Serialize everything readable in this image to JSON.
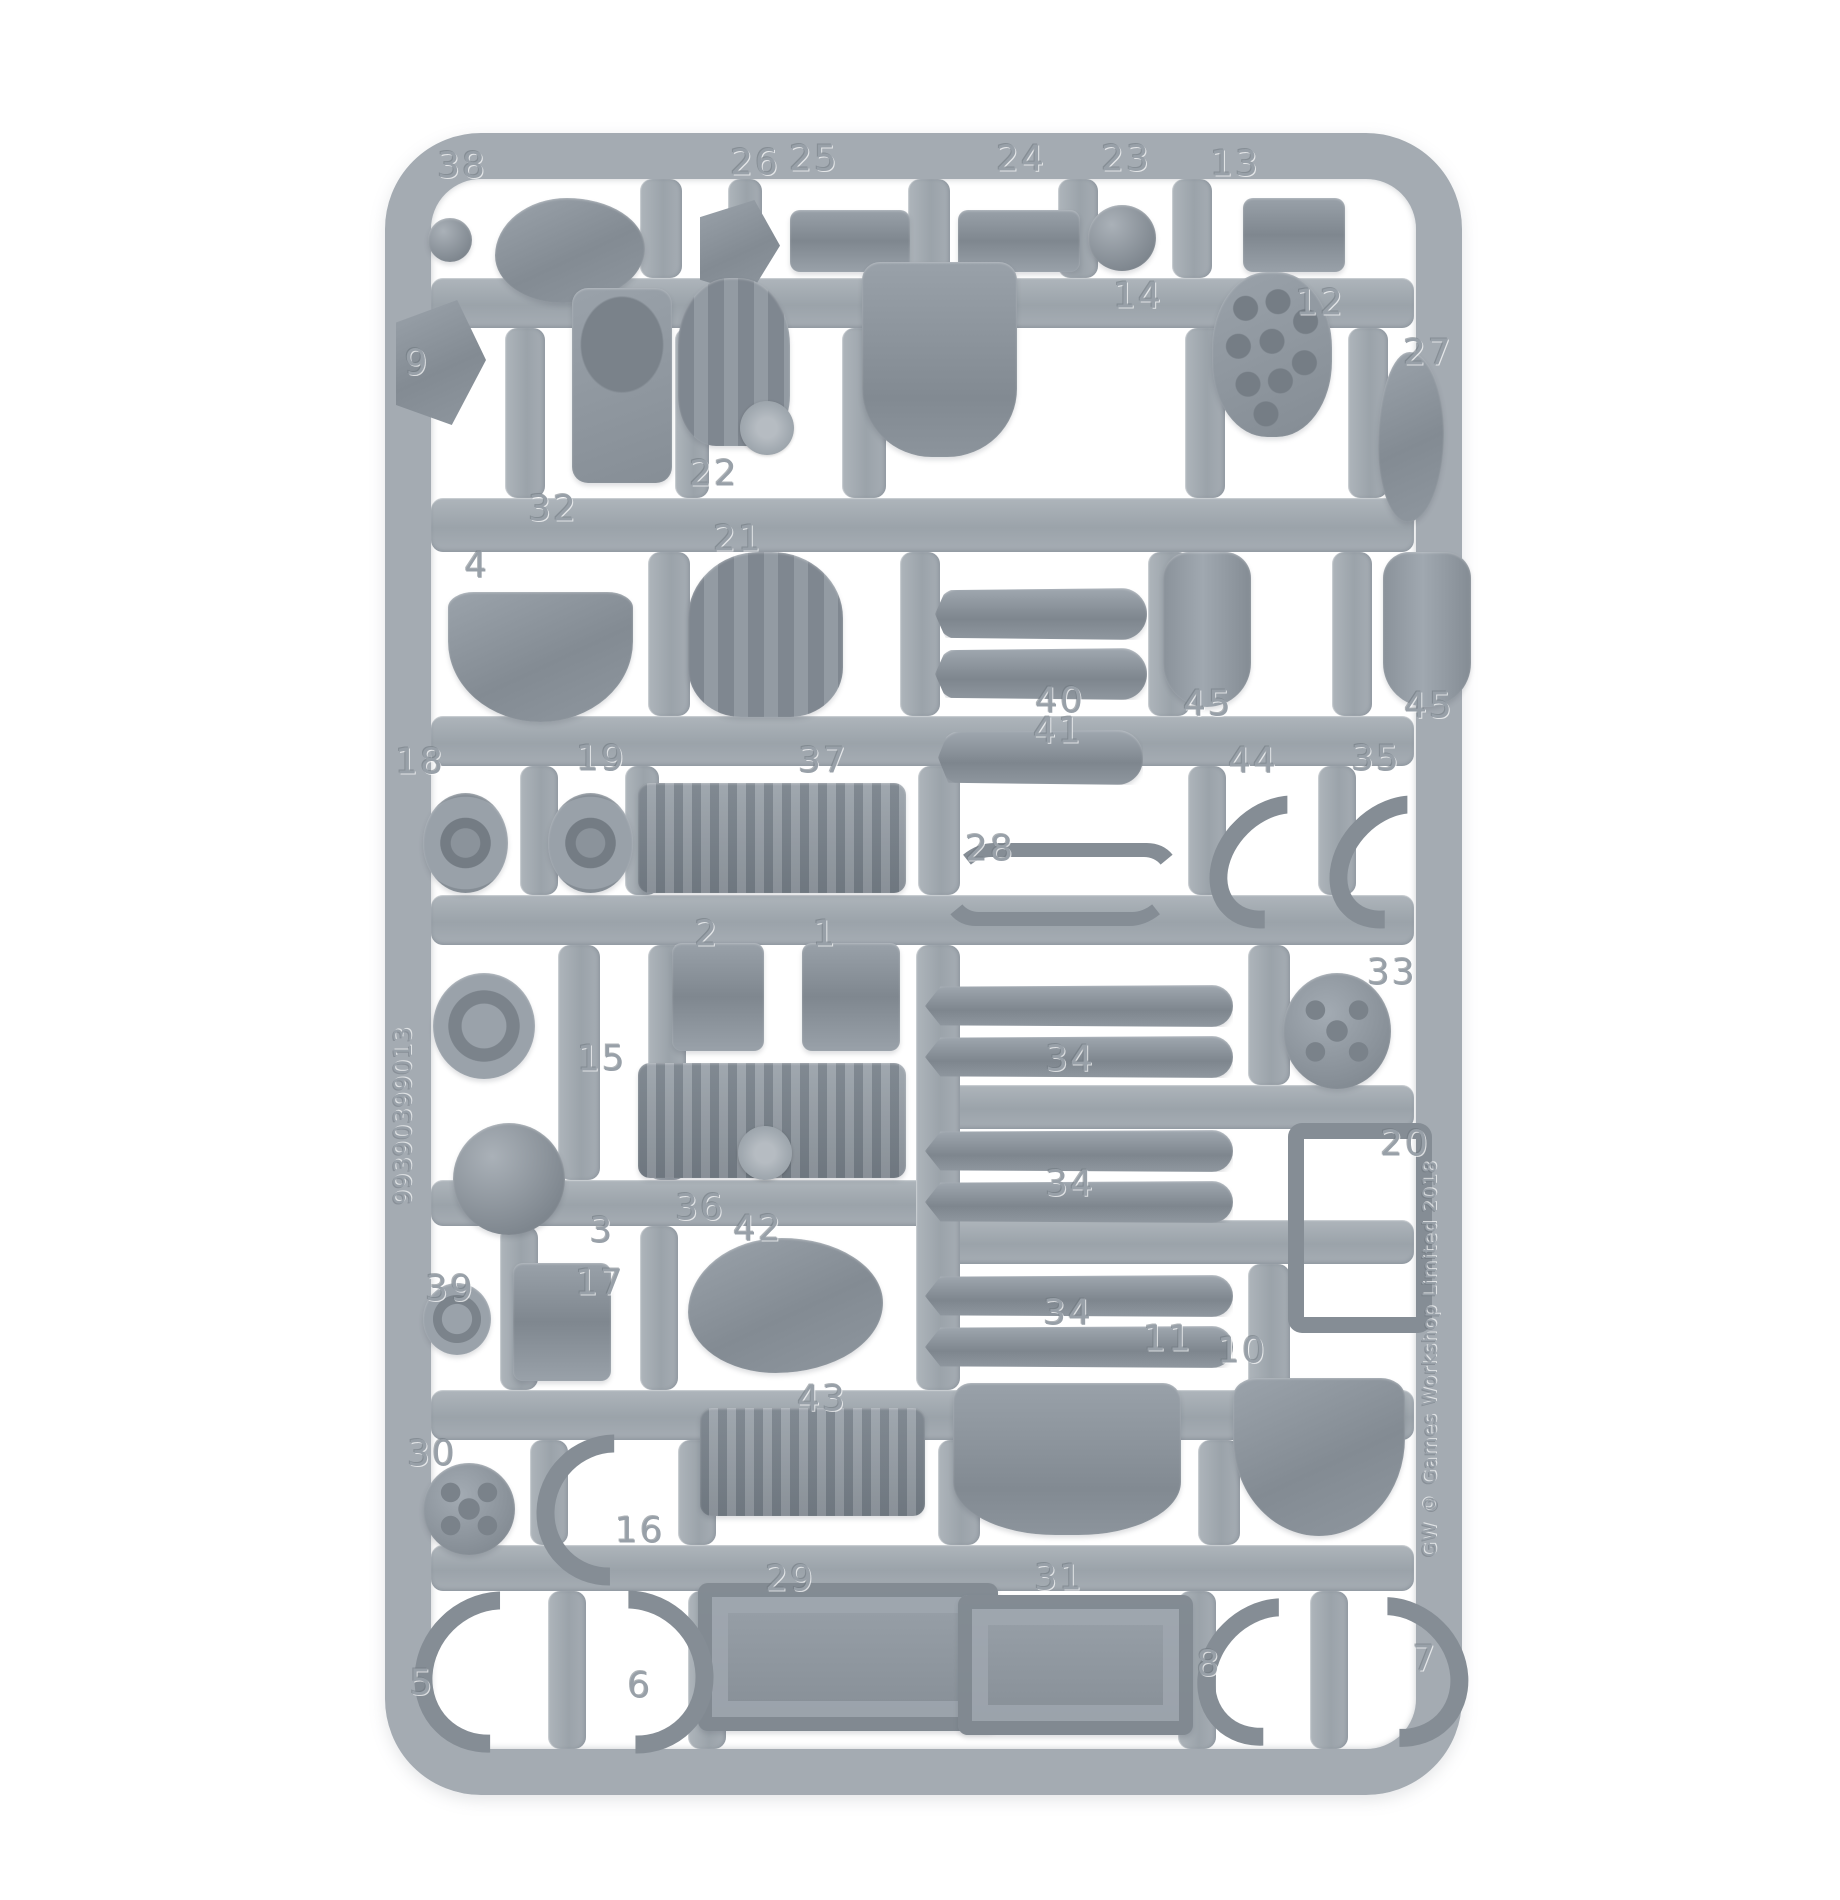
{
  "image": {
    "type": "product-photo",
    "subject": "gray plastic model kit sprue (miniature parts frame) on white background",
    "background_color": "#ffffff"
  },
  "sprue": {
    "plastic_color": "#a4abb2",
    "part_shade_color": "#868e96",
    "left_rail_code": "99390399013",
    "right_rail_code": "GW © Games Workshop Limited 2018",
    "part_labels": [
      {
        "n": "38",
        "x": 462,
        "y": 166
      },
      {
        "n": "26",
        "x": 755,
        "y": 163
      },
      {
        "n": "25",
        "x": 814,
        "y": 159
      },
      {
        "n": "24",
        "x": 1021,
        "y": 159
      },
      {
        "n": "23",
        "x": 1126,
        "y": 159
      },
      {
        "n": "13",
        "x": 1235,
        "y": 164
      },
      {
        "n": "14",
        "x": 1138,
        "y": 296
      },
      {
        "n": "12",
        "x": 1320,
        "y": 303
      },
      {
        "n": "27",
        "x": 1428,
        "y": 353
      },
      {
        "n": "9",
        "x": 417,
        "y": 363
      },
      {
        "n": "32",
        "x": 553,
        "y": 509
      },
      {
        "n": "22",
        "x": 714,
        "y": 474
      },
      {
        "n": "21",
        "x": 738,
        "y": 539
      },
      {
        "n": "4",
        "x": 477,
        "y": 566
      },
      {
        "n": "40",
        "x": 1060,
        "y": 701
      },
      {
        "n": "41",
        "x": 1058,
        "y": 731
      },
      {
        "n": "45",
        "x": 1208,
        "y": 704
      },
      {
        "n": "45",
        "x": 1429,
        "y": 706
      },
      {
        "n": "44",
        "x": 1253,
        "y": 761
      },
      {
        "n": "35",
        "x": 1376,
        "y": 759
      },
      {
        "n": "18",
        "x": 420,
        "y": 762
      },
      {
        "n": "19",
        "x": 601,
        "y": 759
      },
      {
        "n": "37",
        "x": 823,
        "y": 761
      },
      {
        "n": "28",
        "x": 990,
        "y": 849
      },
      {
        "n": "2",
        "x": 707,
        "y": 934
      },
      {
        "n": "1",
        "x": 825,
        "y": 934
      },
      {
        "n": "33",
        "x": 1392,
        "y": 973
      },
      {
        "n": "15",
        "x": 602,
        "y": 1059
      },
      {
        "n": "34",
        "x": 1070,
        "y": 1059
      },
      {
        "n": "34",
        "x": 1070,
        "y": 1184
      },
      {
        "n": "34",
        "x": 1068,
        "y": 1313
      },
      {
        "n": "3",
        "x": 602,
        "y": 1231
      },
      {
        "n": "36",
        "x": 700,
        "y": 1208
      },
      {
        "n": "42",
        "x": 758,
        "y": 1229
      },
      {
        "n": "20",
        "x": 1405,
        "y": 1144
      },
      {
        "n": "39",
        "x": 450,
        "y": 1289
      },
      {
        "n": "17",
        "x": 600,
        "y": 1283
      },
      {
        "n": "43",
        "x": 822,
        "y": 1399
      },
      {
        "n": "11",
        "x": 1168,
        "y": 1339
      },
      {
        "n": "10",
        "x": 1242,
        "y": 1351
      },
      {
        "n": "30",
        "x": 432,
        "y": 1454
      },
      {
        "n": "16",
        "x": 640,
        "y": 1531
      },
      {
        "n": "29",
        "x": 790,
        "y": 1579
      },
      {
        "n": "31",
        "x": 1059,
        "y": 1578
      },
      {
        "n": "5",
        "x": 422,
        "y": 1683
      },
      {
        "n": "6",
        "x": 640,
        "y": 1686
      },
      {
        "n": "8",
        "x": 1209,
        "y": 1664
      },
      {
        "n": "7",
        "x": 1425,
        "y": 1659
      }
    ],
    "rails": {
      "horizontal": [
        {
          "x": 431,
          "y": 278,
          "w": 983,
          "h": 50
        },
        {
          "x": 431,
          "y": 498,
          "w": 983,
          "h": 54
        },
        {
          "x": 431,
          "y": 716,
          "w": 983,
          "h": 50
        },
        {
          "x": 431,
          "y": 895,
          "w": 983,
          "h": 50
        },
        {
          "x": 925,
          "y": 1085,
          "w": 489,
          "h": 44
        },
        {
          "x": 431,
          "y": 1180,
          "w": 500,
          "h": 46
        },
        {
          "x": 925,
          "y": 1220,
          "w": 489,
          "h": 44
        },
        {
          "x": 431,
          "y": 1390,
          "w": 983,
          "h": 50
        },
        {
          "x": 431,
          "y": 1545,
          "w": 983,
          "h": 46
        }
      ],
      "vertical": [
        {
          "x": 640,
          "y": 179,
          "w": 42,
          "h": 99
        },
        {
          "x": 728,
          "y": 179,
          "w": 34,
          "h": 99
        },
        {
          "x": 908,
          "y": 179,
          "w": 42,
          "h": 99
        },
        {
          "x": 1058,
          "y": 179,
          "w": 40,
          "h": 99
        },
        {
          "x": 1172,
          "y": 179,
          "w": 40,
          "h": 99
        },
        {
          "x": 505,
          "y": 328,
          "w": 40,
          "h": 170
        },
        {
          "x": 675,
          "y": 328,
          "w": 34,
          "h": 170
        },
        {
          "x": 842,
          "y": 328,
          "w": 44,
          "h": 170
        },
        {
          "x": 1185,
          "y": 328,
          "w": 40,
          "h": 170
        },
        {
          "x": 1348,
          "y": 328,
          "w": 40,
          "h": 170
        },
        {
          "x": 648,
          "y": 552,
          "w": 42,
          "h": 164
        },
        {
          "x": 900,
          "y": 552,
          "w": 40,
          "h": 164
        },
        {
          "x": 1148,
          "y": 552,
          "w": 42,
          "h": 164
        },
        {
          "x": 1332,
          "y": 552,
          "w": 40,
          "h": 164
        },
        {
          "x": 520,
          "y": 766,
          "w": 38,
          "h": 129
        },
        {
          "x": 625,
          "y": 766,
          "w": 34,
          "h": 129
        },
        {
          "x": 918,
          "y": 766,
          "w": 42,
          "h": 129
        },
        {
          "x": 1188,
          "y": 766,
          "w": 38,
          "h": 129
        },
        {
          "x": 1318,
          "y": 766,
          "w": 38,
          "h": 129
        },
        {
          "x": 558,
          "y": 945,
          "w": 42,
          "h": 235
        },
        {
          "x": 648,
          "y": 945,
          "w": 38,
          "h": 235
        },
        {
          "x": 916,
          "y": 945,
          "w": 44,
          "h": 445
        },
        {
          "x": 1248,
          "y": 945,
          "w": 42,
          "h": 140
        },
        {
          "x": 500,
          "y": 1226,
          "w": 38,
          "h": 164
        },
        {
          "x": 640,
          "y": 1226,
          "w": 38,
          "h": 164
        },
        {
          "x": 1248,
          "y": 1264,
          "w": 42,
          "h": 126
        },
        {
          "x": 530,
          "y": 1440,
          "w": 38,
          "h": 105
        },
        {
          "x": 678,
          "y": 1440,
          "w": 38,
          "h": 105
        },
        {
          "x": 938,
          "y": 1440,
          "w": 42,
          "h": 105
        },
        {
          "x": 1198,
          "y": 1440,
          "w": 42,
          "h": 105
        },
        {
          "x": 548,
          "y": 1591,
          "w": 38,
          "h": 158
        },
        {
          "x": 688,
          "y": 1591,
          "w": 38,
          "h": 158
        },
        {
          "x": 1178,
          "y": 1591,
          "w": 38,
          "h": 158
        },
        {
          "x": 1310,
          "y": 1591,
          "w": 38,
          "h": 158
        }
      ]
    },
    "parts": [
      {
        "name": "ball-joint-pin",
        "shape": "ball",
        "x": 428,
        "y": 218,
        "w": 44,
        "h": 44
      },
      {
        "name": "sensor-head",
        "shape": "blob",
        "x": 495,
        "y": 198,
        "w": 150,
        "h": 105
      },
      {
        "name": "small-bracket",
        "shape": "wedge",
        "x": 700,
        "y": 200,
        "w": 80,
        "h": 95
      },
      {
        "name": "bolter-body-a",
        "shape": "gadget",
        "x": 790,
        "y": 210,
        "w": 120,
        "h": 62
      },
      {
        "name": "bolter-body-b",
        "shape": "gadget",
        "x": 958,
        "y": 210,
        "w": 122,
        "h": 62
      },
      {
        "name": "orb-joint",
        "shape": "ball",
        "x": 1088,
        "y": 205,
        "w": 68,
        "h": 66
      },
      {
        "name": "twin-drum",
        "shape": "gadget",
        "x": 1243,
        "y": 198,
        "w": 102,
        "h": 74
      },
      {
        "name": "angled-vane",
        "shape": "wedge",
        "x": 396,
        "y": 300,
        "w": 90,
        "h": 125
      },
      {
        "name": "hatch-plate",
        "shape": "hatch",
        "x": 572,
        "y": 288,
        "w": 100,
        "h": 195
      },
      {
        "name": "claw-gauntlet-a",
        "shape": "claw",
        "x": 678,
        "y": 278,
        "w": 112,
        "h": 168
      },
      {
        "name": "torso-panel",
        "shape": "panel",
        "x": 862,
        "y": 262,
        "w": 155,
        "h": 195
      },
      {
        "name": "missile-plate",
        "shape": "bumps",
        "x": 1212,
        "y": 272,
        "w": 120,
        "h": 165
      },
      {
        "name": "small-arm",
        "shape": "blob",
        "x": 1378,
        "y": 352,
        "w": 66,
        "h": 170
      },
      {
        "name": "backpack-shield",
        "shape": "shield",
        "x": 448,
        "y": 592,
        "w": 185,
        "h": 130
      },
      {
        "name": "claw-gauntlet-b",
        "shape": "claw",
        "x": 688,
        "y": 552,
        "w": 155,
        "h": 165
      },
      {
        "name": "twin-cylinder-top",
        "shape": "rod",
        "x": 935,
        "y": 588,
        "w": 212,
        "h": 52
      },
      {
        "name": "twin-cylinder-bottom",
        "shape": "rod",
        "x": 935,
        "y": 648,
        "w": 212,
        "h": 52
      },
      {
        "name": "single-cylinder",
        "shape": "rod",
        "x": 938,
        "y": 730,
        "w": 205,
        "h": 55
      },
      {
        "name": "fuel-tank-a",
        "shape": "tank",
        "x": 1163,
        "y": 552,
        "w": 88,
        "h": 155
      },
      {
        "name": "fuel-tank-b",
        "shape": "tank",
        "x": 1383,
        "y": 552,
        "w": 88,
        "h": 155
      },
      {
        "name": "pulley-wheel-a",
        "shape": "wheel",
        "x": 423,
        "y": 793,
        "w": 85,
        "h": 100
      },
      {
        "name": "pulley-wheel-b",
        "shape": "wheel",
        "x": 548,
        "y": 793,
        "w": 85,
        "h": 100
      },
      {
        "name": "engine-block-a",
        "shape": "engine",
        "x": 638,
        "y": 783,
        "w": 268,
        "h": 110
      },
      {
        "name": "hose-pair",
        "shape": "hose-s",
        "x": 945,
        "y": 843,
        "w": 205,
        "h": 55
      },
      {
        "name": "elbow-hose-a",
        "shape": "hose-l",
        "x": 1218,
        "y": 788,
        "w": 80,
        "h": 112
      },
      {
        "name": "elbow-hose-b",
        "shape": "hose-l",
        "x": 1338,
        "y": 788,
        "w": 80,
        "h": 112
      },
      {
        "name": "porthole",
        "shape": "ring",
        "x": 433,
        "y": 973,
        "w": 102,
        "h": 106
      },
      {
        "name": "clamp-a",
        "shape": "gadget",
        "x": 672,
        "y": 943,
        "w": 92,
        "h": 108
      },
      {
        "name": "clamp-b",
        "shape": "gadget",
        "x": 802,
        "y": 943,
        "w": 98,
        "h": 108
      },
      {
        "name": "piston-rod-a1",
        "shape": "rod",
        "x": 925,
        "y": 985,
        "w": 308,
        "h": 42
      },
      {
        "name": "piston-rod-a2",
        "shape": "rod",
        "x": 925,
        "y": 1036,
        "w": 308,
        "h": 42
      },
      {
        "name": "rivet-drum",
        "shape": "drum",
        "x": 1283,
        "y": 973,
        "w": 108,
        "h": 116
      },
      {
        "name": "engine-block-b",
        "shape": "engine",
        "x": 638,
        "y": 1063,
        "w": 268,
        "h": 115
      },
      {
        "name": "orb-sphere",
        "shape": "ball",
        "x": 453,
        "y": 1123,
        "w": 112,
        "h": 112
      },
      {
        "name": "piston-rod-b1",
        "shape": "rod",
        "x": 925,
        "y": 1130,
        "w": 308,
        "h": 42
      },
      {
        "name": "piston-rod-b2",
        "shape": "rod",
        "x": 925,
        "y": 1181,
        "w": 308,
        "h": 42
      },
      {
        "name": "frame-bracket",
        "shape": "frame",
        "x": 1288,
        "y": 1123,
        "w": 112,
        "h": 178
      },
      {
        "name": "small-rosette",
        "shape": "ring",
        "x": 423,
        "y": 1283,
        "w": 68,
        "h": 72
      },
      {
        "name": "cylinder-stack",
        "shape": "gadget",
        "x": 513,
        "y": 1263,
        "w": 98,
        "h": 118
      },
      {
        "name": "curved-cowling",
        "shape": "blob",
        "x": 688,
        "y": 1238,
        "w": 195,
        "h": 135
      },
      {
        "name": "piston-rod-c1",
        "shape": "rod",
        "x": 925,
        "y": 1275,
        "w": 308,
        "h": 42
      },
      {
        "name": "piston-rod-c2",
        "shape": "rod",
        "x": 925,
        "y": 1326,
        "w": 308,
        "h": 42
      },
      {
        "name": "rail-gun-body",
        "shape": "engine",
        "x": 700,
        "y": 1408,
        "w": 225,
        "h": 108
      },
      {
        "name": "hex-housing",
        "shape": "panel",
        "x": 953,
        "y": 1383,
        "w": 228,
        "h": 152
      },
      {
        "name": "crested-shield",
        "shape": "shield",
        "x": 1233,
        "y": 1378,
        "w": 172,
        "h": 158
      },
      {
        "name": "round-rosette",
        "shape": "drum",
        "x": 423,
        "y": 1463,
        "w": 92,
        "h": 92
      },
      {
        "name": "curved-horn",
        "shape": "hose-l",
        "x": 538,
        "y": 1433,
        "w": 112,
        "h": 118
      },
      {
        "name": "ammo-crate-a",
        "shape": "crate",
        "x": 698,
        "y": 1583,
        "w": 300,
        "h": 148
      },
      {
        "name": "ammo-crate-b",
        "shape": "crate",
        "x": 958,
        "y": 1595,
        "w": 235,
        "h": 140
      },
      {
        "name": "exhaust-hose-a",
        "shape": "hose-l",
        "x": 418,
        "y": 1588,
        "w": 118,
        "h": 132
      },
      {
        "name": "exhaust-hose-b",
        "shape": "hose-r",
        "x": 553,
        "y": 1588,
        "w": 122,
        "h": 132
      },
      {
        "name": "exhaust-hose-c",
        "shape": "hose-l",
        "x": 1203,
        "y": 1593,
        "w": 100,
        "h": 122
      },
      {
        "name": "exhaust-hose-d",
        "shape": "hose-r",
        "x": 1323,
        "y": 1593,
        "w": 105,
        "h": 122
      },
      {
        "name": "mold-hub-top",
        "shape": "hub",
        "x": 740,
        "y": 401,
        "w": 54,
        "h": 54
      },
      {
        "name": "mold-hub-bottom",
        "shape": "hub",
        "x": 738,
        "y": 1126,
        "w": 54,
        "h": 54
      }
    ]
  }
}
